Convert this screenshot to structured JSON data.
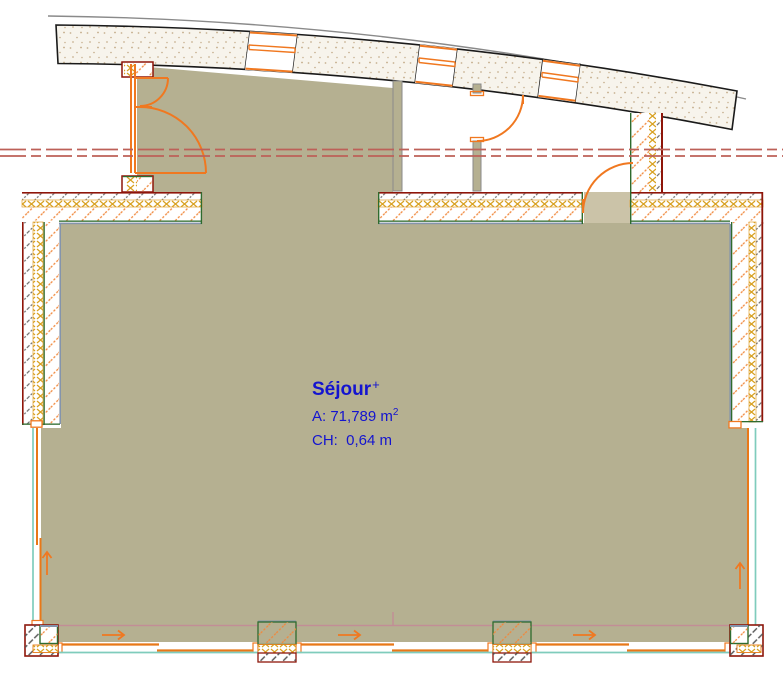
{
  "room_label": {
    "name": "Séjour",
    "marker": "+",
    "area_text": "A: 71,789 m",
    "area_exponent": "2",
    "ceiling_height_text": "CH:  0,64 m"
  },
  "colors": {
    "room_fill": "#b5b091",
    "door_threshold_fill": "#cbc3a8",
    "wall_hatch_orange": "#f0883c",
    "door_orange": "#f07820",
    "wall_outline_dark_red": "#8e1509",
    "wall_inner_green": "#2e6b2e",
    "wall_inner_blue_gray": "#8494ac",
    "insulation_yellow": "#d8a020",
    "curtain_wall_teal": "#7fccbc",
    "sill_pink": "#c28d96",
    "reference_line_red": "#bd6058",
    "band_stipple_beige": "#c9b393",
    "band_outline_black": "#1a1a1a",
    "label_blue": "#1414cf"
  }
}
